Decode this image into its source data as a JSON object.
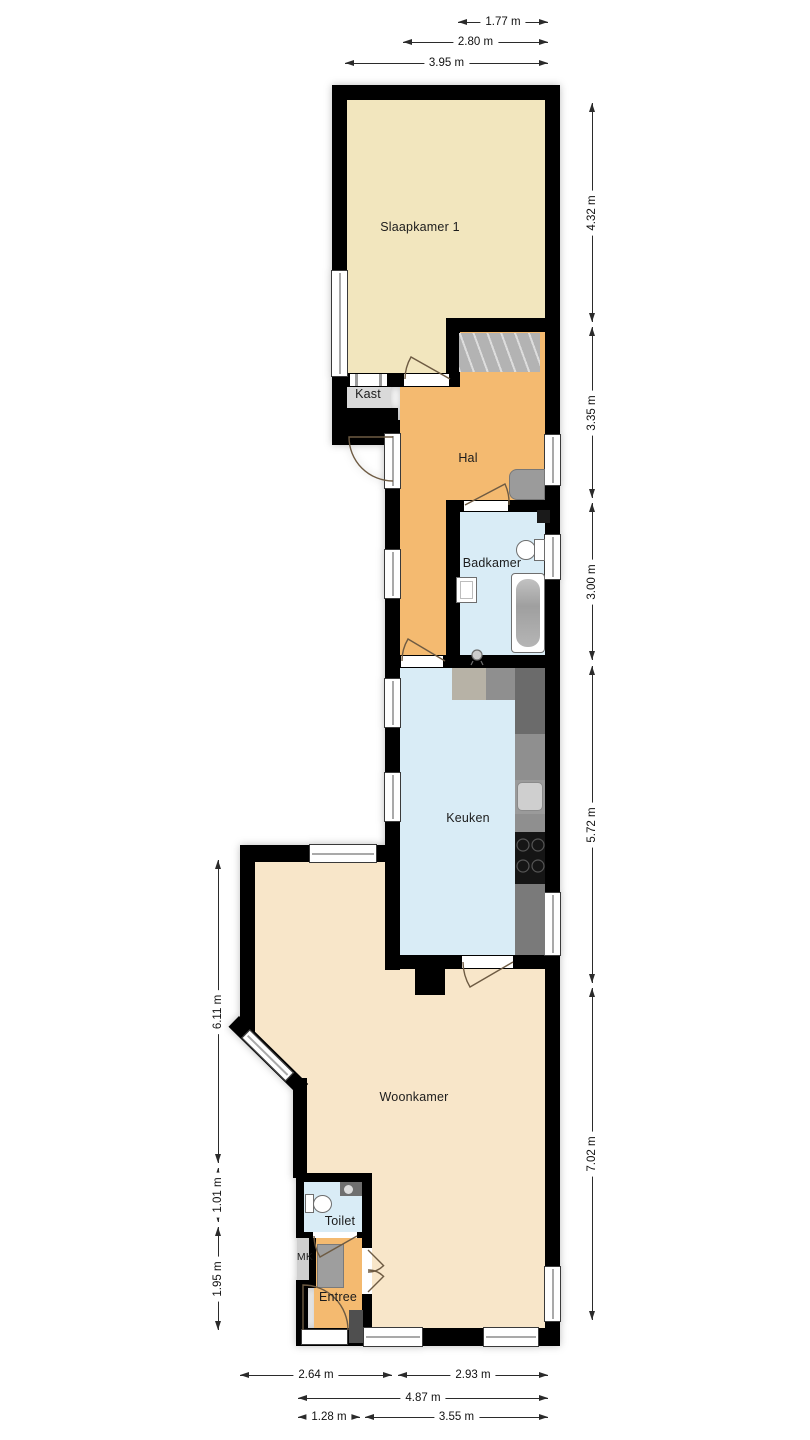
{
  "plan": {
    "type": "floorplan",
    "rooms": {
      "slaapkamer": {
        "label": "Slaapkamer 1",
        "fill": "#F2E6BE"
      },
      "kast": {
        "label": "Kast",
        "fill": "#D9D9D9"
      },
      "hal": {
        "label": "Hal",
        "fill": "#F4BA70"
      },
      "badkamer": {
        "label": "Badkamer",
        "fill": "#D9ECF6"
      },
      "keuken": {
        "label": "Keuken",
        "fill": "#D9ECF6"
      },
      "woonkamer": {
        "label": "Woonkamer",
        "fill": "#F8E6C9"
      },
      "toilet": {
        "label": "Toilet",
        "fill": "#D9ECF6"
      },
      "mk": {
        "label": "MK",
        "fill": "#CFCFCF"
      },
      "entree": {
        "label": "Entree",
        "fill": "#F4BA70"
      }
    },
    "colors": {
      "wall": "#000000",
      "window": "#FFFFFF",
      "door_arc": "#6E5B43",
      "counter_dark": "#6B6B6B",
      "counter_mid": "#8F8F8F",
      "stairs": "#B3B3B3"
    },
    "dimensions": {
      "top": [
        {
          "label": "1.77 m"
        },
        {
          "label": "2.80 m"
        },
        {
          "label": "3.95 m"
        }
      ],
      "right": [
        {
          "label": "4.32 m"
        },
        {
          "label": "3.35 m"
        },
        {
          "label": "3.00 m"
        },
        {
          "label": "5.72 m"
        },
        {
          "label": "7.02 m"
        }
      ],
      "left": [
        {
          "label": "6.11 m"
        },
        {
          "label": "1.01 m"
        },
        {
          "label": "1.95 m"
        }
      ],
      "bottom": [
        {
          "label": "2.64 m"
        },
        {
          "label": "2.93 m"
        },
        {
          "label": "4.87 m"
        },
        {
          "label": "1.28 m"
        },
        {
          "label": "3.55 m"
        }
      ]
    }
  }
}
